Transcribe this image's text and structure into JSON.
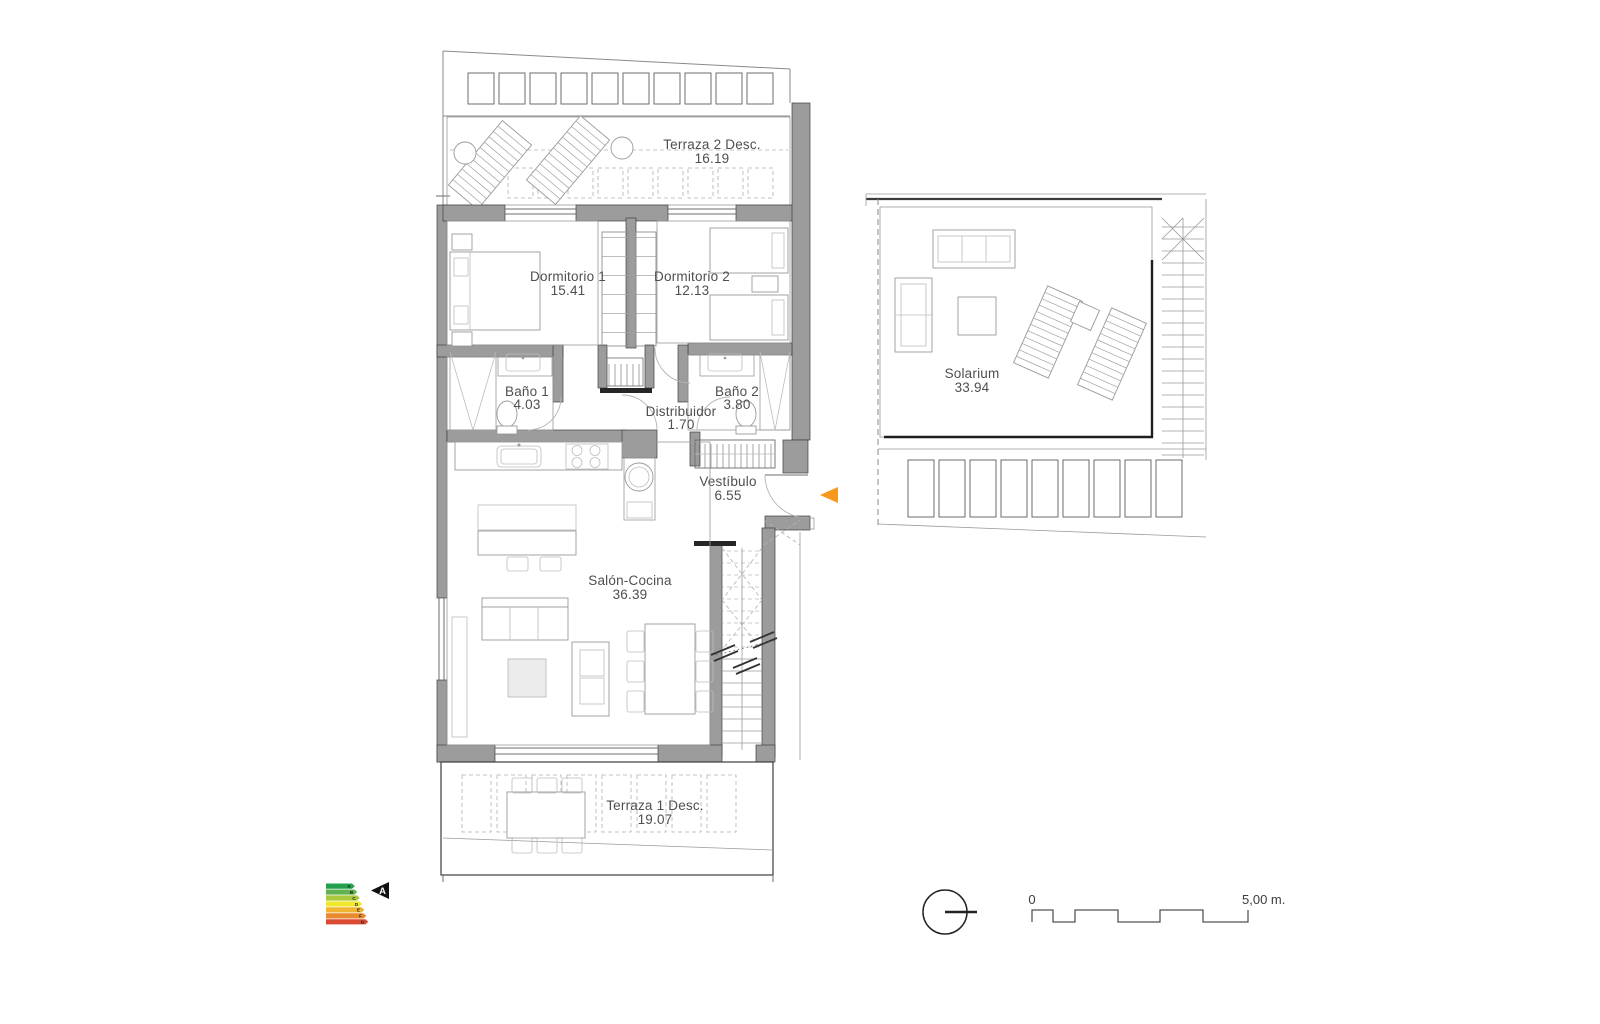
{
  "plan": {
    "rooms": [
      {
        "id": "terraza2",
        "name": "Terraza 2 Desc.",
        "area": "16.19"
      },
      {
        "id": "dormitorio1",
        "name": "Dormitorio 1",
        "area": "15.41"
      },
      {
        "id": "dormitorio2",
        "name": "Dormitorio 2",
        "area": "12.13"
      },
      {
        "id": "bano1",
        "name": "Baño 1",
        "area": "4.03"
      },
      {
        "id": "bano2",
        "name": "Baño 2",
        "area": "3.80"
      },
      {
        "id": "distribuidor",
        "name": "Distribuidor",
        "area": "1.70"
      },
      {
        "id": "vestibulo",
        "name": "Vestíbulo",
        "area": "6.55"
      },
      {
        "id": "salon",
        "name": "Salón-Cocina",
        "area": "36.39"
      },
      {
        "id": "terraza1",
        "name": "Terraza 1 Desc.",
        "area": "19.07"
      },
      {
        "id": "solarium",
        "name": "Solarium",
        "area": "33.94"
      }
    ]
  },
  "energy_label": {
    "ratings": [
      {
        "letter": "A",
        "color": "#22A04E"
      },
      {
        "letter": "B",
        "color": "#5FB24F"
      },
      {
        "letter": "C",
        "color": "#A9C83B"
      },
      {
        "letter": "D",
        "color": "#F1E72D"
      },
      {
        "letter": "E",
        "color": "#F0B431"
      },
      {
        "letter": "F",
        "color": "#E98A2F"
      },
      {
        "letter": "G",
        "color": "#DB4A33"
      }
    ],
    "current_rating": "A",
    "arrow_color": "#111111"
  },
  "entrance_marker": {
    "color": "#F6981E"
  },
  "scale_bar": {
    "zero_label": "0",
    "end_label": "5,00 m."
  },
  "colors": {
    "wall": "#9c9c9c",
    "outline": "#4a4a4a",
    "furniture_line": "#9a9a9a",
    "text": "#4f4f4f",
    "background": "#ffffff"
  }
}
